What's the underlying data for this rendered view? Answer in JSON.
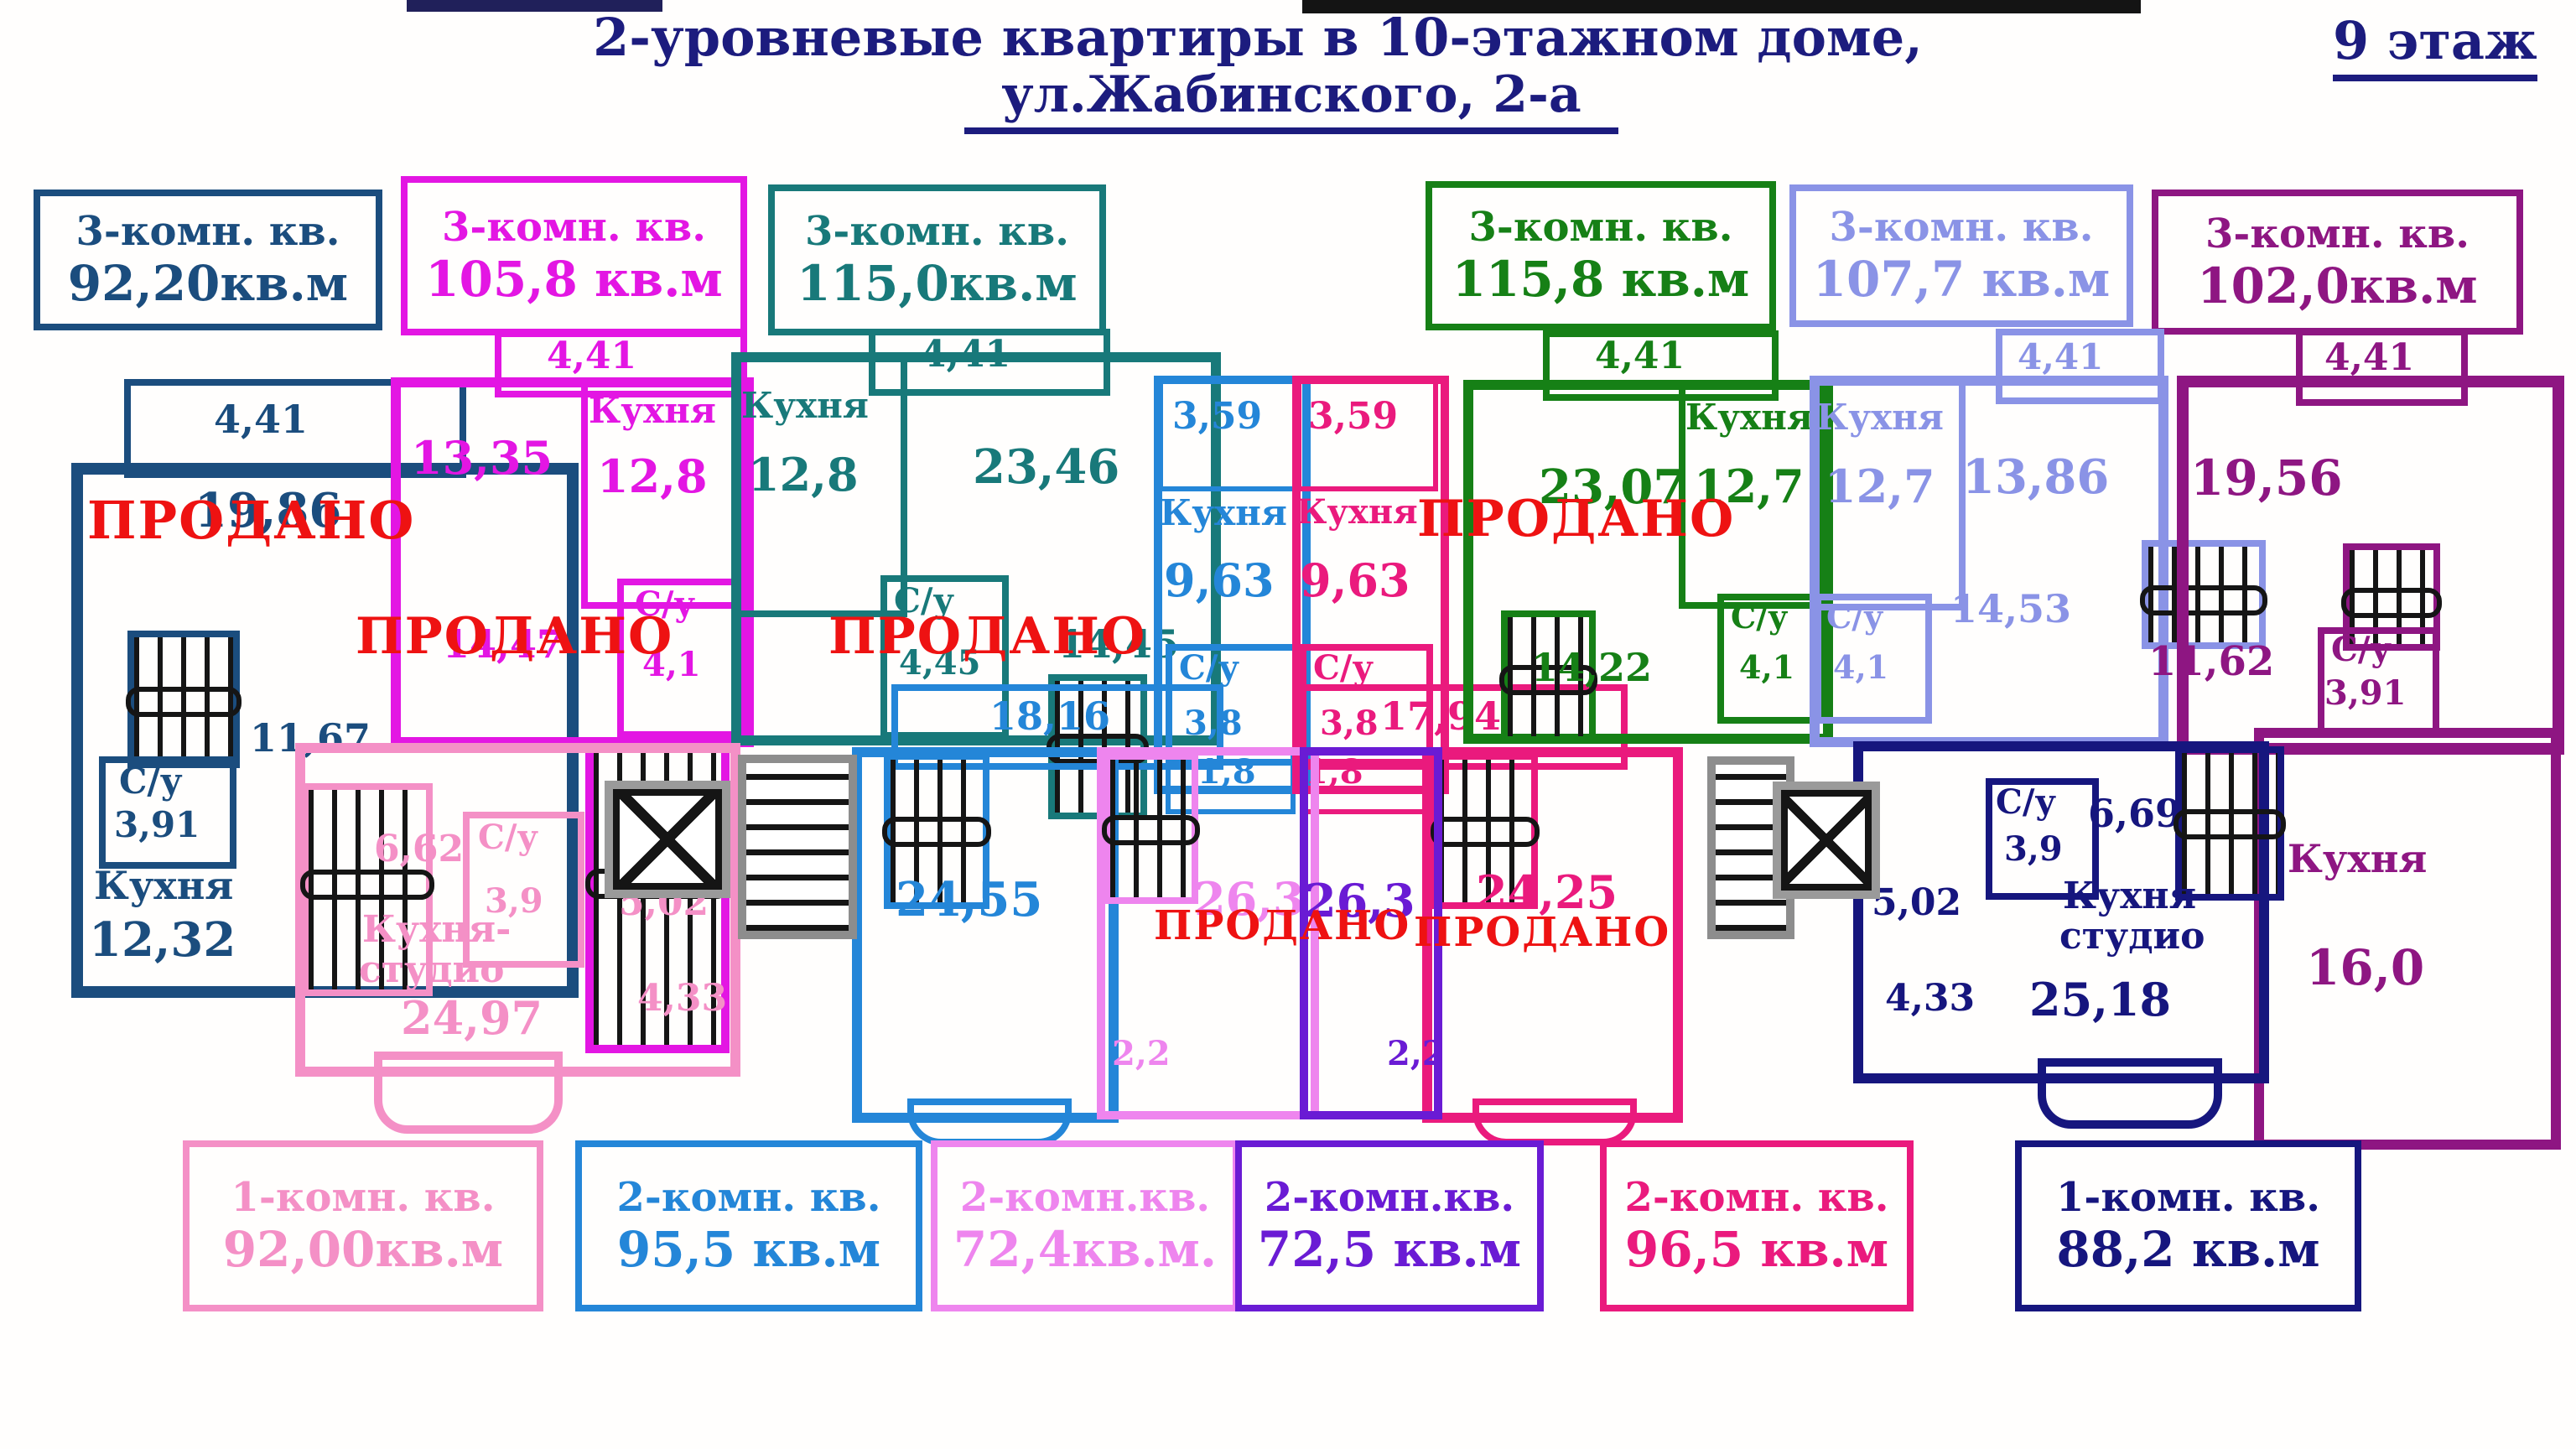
{
  "title": {
    "line1": "2-уровневые квартиры в 10-этажном доме,",
    "line2": "ул.Жабинского, 2-а",
    "floor": "9 этаж"
  },
  "sold_stamp": "ПРОДАНО",
  "colors": {
    "navy_left": "#1b4d7e",
    "magenta": "#e316e3",
    "teal": "#18797a",
    "blue": "#2486d8",
    "crimson": "#ea1a7d",
    "green": "#168016",
    "lavender": "#8a93e6",
    "purple": "#8e1682",
    "pink": "#f490c6",
    "light_pink": "#ee85ee",
    "violet": "#6a1bd4",
    "navy_right": "#16167e",
    "sold_red": "#ee1212",
    "title_navy": "#1c1c7e"
  },
  "top_labels": [
    {
      "type": "3-комн. кв.",
      "area": "92,20кв.м"
    },
    {
      "type": "3-комн. кв.",
      "area": "105,8 кв.м"
    },
    {
      "type": "3-комн. кв.",
      "area": "115,0кв.м"
    },
    {
      "type": "3-комн. кв.",
      "area": "115,8 кв.м"
    },
    {
      "type": "3-комн. кв.",
      "area": "107,7 кв.м"
    },
    {
      "type": "3-комн. кв.",
      "area": "102,0кв.м"
    }
  ],
  "bottom_labels": [
    {
      "type": "1-комн. кв.",
      "area": "92,00кв.м"
    },
    {
      "type": "2-комн. кв.",
      "area": "95,5 кв.м"
    },
    {
      "type": "2-комн.кв.",
      "area": "72,4кв.м."
    },
    {
      "type": "2-комн.кв.",
      "area": "72,5 кв.м"
    },
    {
      "type": "2-комн. кв.",
      "area": "96,5 кв.м"
    },
    {
      "type": "1-комн. кв.",
      "area": "88,2 кв.м"
    }
  ],
  "plan": {
    "a1": {
      "balc": "4,41",
      "room": "19,86",
      "hall": "11,67",
      "wc": "С/у",
      "wcv": "3,91",
      "k": "Кухня",
      "kv": "12,32"
    },
    "a2": {
      "balc": "4,41",
      "room": "13,35",
      "k": "Кухня",
      "kv": "12,8",
      "wc": "С/у",
      "wcv": "4,1",
      "room2": "14,47"
    },
    "a3": {
      "k": "Кухня",
      "kv": "12,8",
      "balc": "4,41",
      "room": "23,46",
      "wc": "С/у",
      "wcv": "4,45",
      "room2": "14,45"
    },
    "a4": {
      "balc": "3,59",
      "k": "Кухня",
      "kv": "9,63",
      "wc": "С/у",
      "wcv": "3,8",
      "cl": "1,8",
      "hall": "18,16",
      "room": "24,55"
    },
    "a5": {
      "balc": "3,59",
      "k": "Кухня",
      "kv": "9,63",
      "wc": "С/у",
      "wcv": "3,8",
      "cl": "1,8",
      "hall": "17,94",
      "room": "24,25"
    },
    "a6": {
      "balc": "4,41",
      "room": "23,07",
      "k": "Кухня",
      "kv": "12,7",
      "wc": "С/у",
      "wcv": "4,1",
      "hall": "14,22"
    },
    "a7": {
      "k": "Кухня",
      "kv": "12,7",
      "wc": "С/у",
      "wcv": "4,1",
      "balc": "4,41",
      "room": "13,86",
      "hall": "14,53"
    },
    "a8": {
      "balc": "4,41",
      "room": "19,56",
      "hall": "11,62",
      "wc": "С/у",
      "wcv": "3,91",
      "k": "Кухня",
      "kv": "16,0"
    },
    "a9": {
      "hall": "6,62",
      "wc": "С/у",
      "wcv": "3,9",
      "k1": "Кухня-",
      "k2": "студио",
      "kv": "24,97",
      "r2": "5,02",
      "r3": "4,33"
    },
    "a10": {
      "room": "26,3",
      "balc": "2,2"
    },
    "a11": {
      "room": "26,3",
      "balc": "2,2"
    },
    "a12": {
      "wc": "С/у",
      "wcv": "3,9",
      "hall": "6,69",
      "r2": "5,02",
      "r3": "4,33",
      "k1": "Кухня-",
      "k2": "студио",
      "kv": "25,18"
    }
  }
}
